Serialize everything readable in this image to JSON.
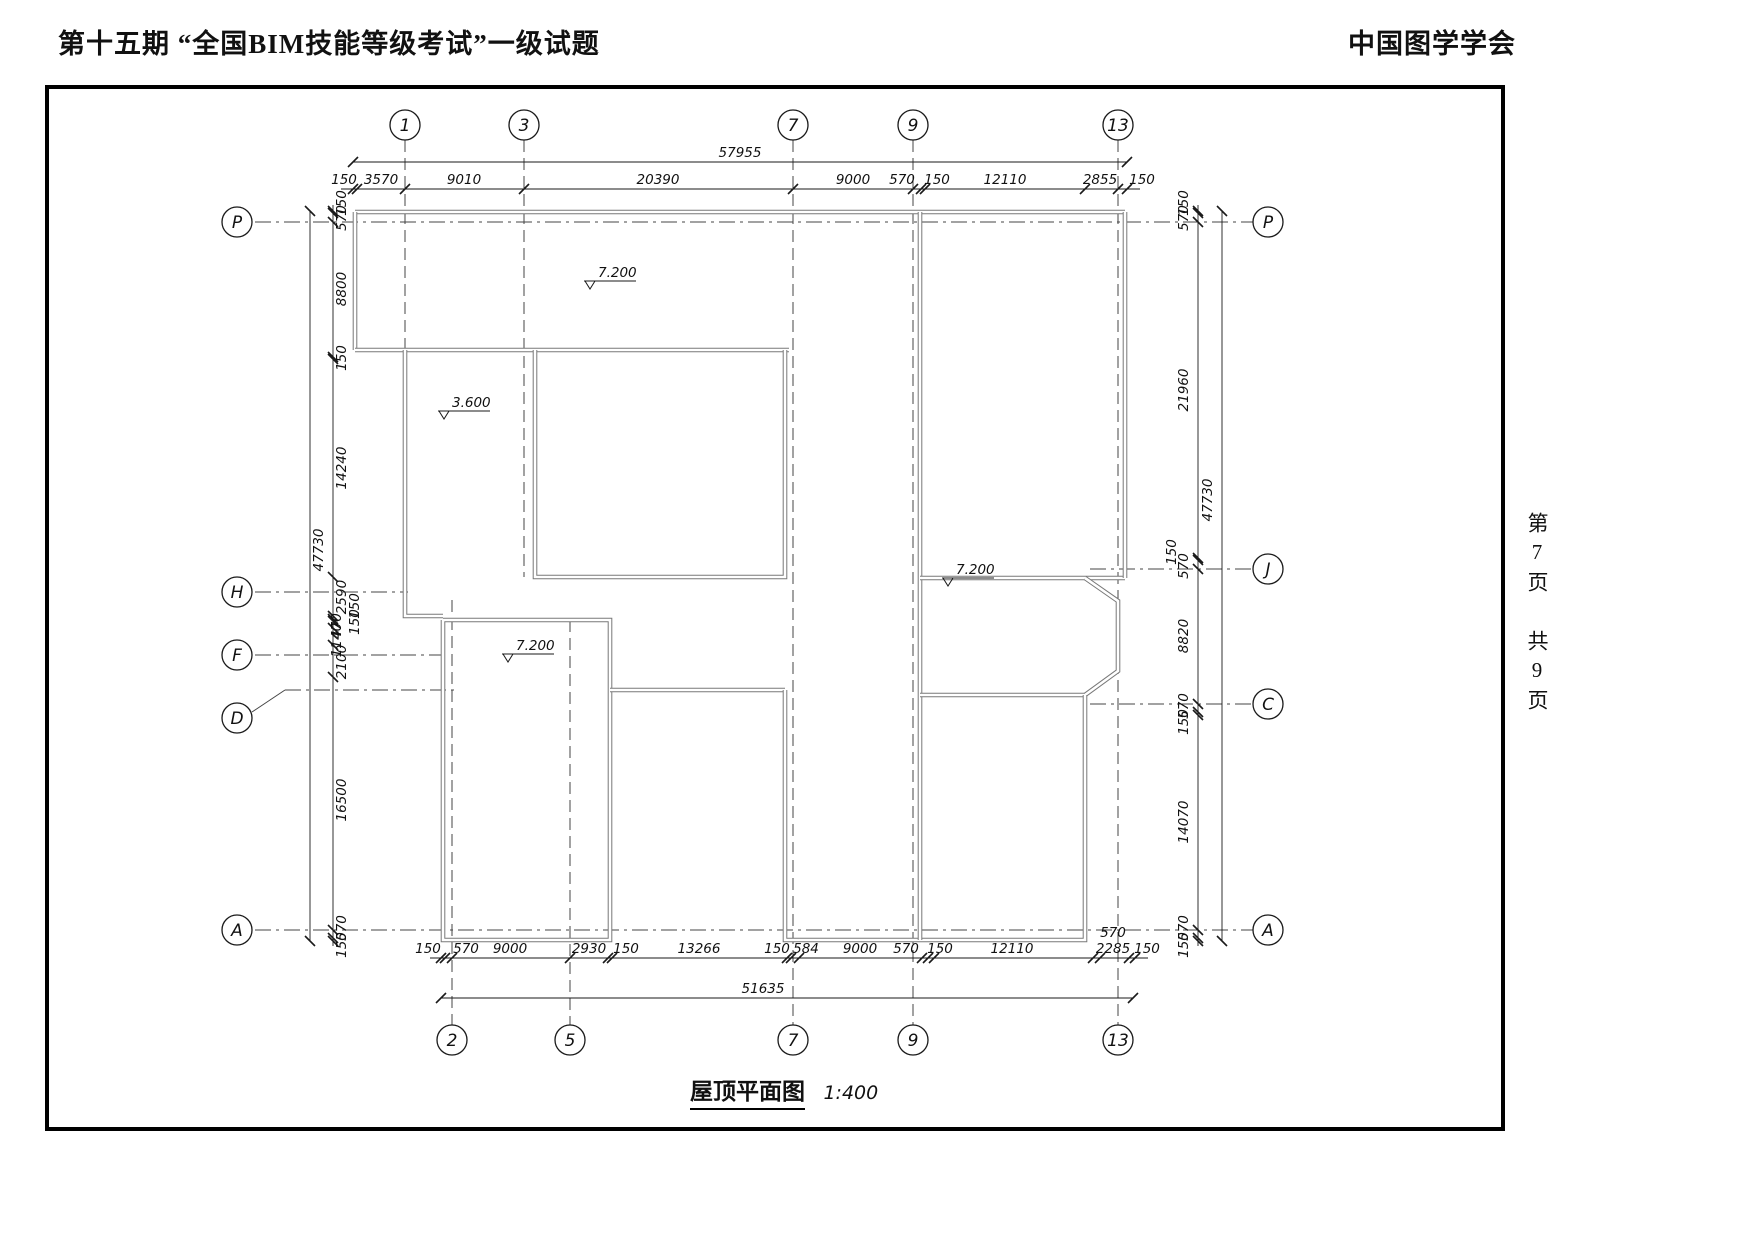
{
  "header": {
    "title_left": "第十五期 “全国BIM技能等级考试”一级试题",
    "title_right": "中国图学学会"
  },
  "side_note": {
    "text": "第7页 共9页"
  },
  "caption": {
    "title": "屋顶平面图",
    "scale": "1:400"
  },
  "drawing": {
    "colors": {
      "wall_outer": "#787878",
      "wall_inner": "#ffffff",
      "line": "#1a1a1a",
      "grid": "#444444"
    },
    "bubbles": [
      {
        "label": "1",
        "x": 405,
        "y": 125
      },
      {
        "label": "3",
        "x": 524,
        "y": 125
      },
      {
        "label": "7",
        "x": 793,
        "y": 125
      },
      {
        "label": "9",
        "x": 913,
        "y": 125
      },
      {
        "label": "13",
        "x": 1118,
        "y": 125
      },
      {
        "label": "2",
        "x": 452,
        "y": 1040
      },
      {
        "label": "5",
        "x": 570,
        "y": 1040
      },
      {
        "label": "7",
        "x": 793,
        "y": 1040
      },
      {
        "label": "9",
        "x": 913,
        "y": 1040
      },
      {
        "label": "13",
        "x": 1118,
        "y": 1040
      },
      {
        "label": "P",
        "x": 237,
        "y": 222
      },
      {
        "label": "H",
        "x": 237,
        "y": 592
      },
      {
        "label": "F",
        "x": 237,
        "y": 655
      },
      {
        "label": "D",
        "x": 237,
        "y": 718
      },
      {
        "label": "A",
        "x": 237,
        "y": 930
      },
      {
        "label": "P",
        "x": 1268,
        "y": 222
      },
      {
        "label": "J",
        "x": 1268,
        "y": 569
      },
      {
        "label": "C",
        "x": 1268,
        "y": 704
      },
      {
        "label": "A",
        "x": 1268,
        "y": 930
      }
    ],
    "vgrids": [
      {
        "x": 405,
        "y1": 140,
        "y2": 616
      },
      {
        "x": 524,
        "y1": 140,
        "y2": 577
      },
      {
        "x": 793,
        "y1": 140,
        "y2": 1025
      },
      {
        "x": 913,
        "y1": 140,
        "y2": 1025
      },
      {
        "x": 1118,
        "y1": 140,
        "y2": 1025
      },
      {
        "x": 452,
        "y1": 600,
        "y2": 1025
      },
      {
        "x": 570,
        "y1": 620,
        "y2": 1025
      }
    ],
    "hgrids": [
      {
        "y": 222,
        "x1": 255,
        "x2": 1253
      },
      {
        "y": 930,
        "x1": 255,
        "x2": 1253
      },
      {
        "y": 592,
        "x1": 255,
        "x2": 408
      },
      {
        "y": 655,
        "x1": 255,
        "x2": 445
      },
      {
        "y": 569,
        "x1": 1090,
        "x2": 1253
      },
      {
        "y": 704,
        "x1": 1090,
        "x2": 1253
      },
      {
        "y": 690,
        "x1": 285,
        "x2": 455
      }
    ],
    "leaders": [
      [
        [
          252,
          712
        ],
        [
          285,
          690
        ]
      ]
    ],
    "walls": [
      [
        [
          355,
          212
        ],
        [
          1125,
          212
        ]
      ],
      [
        [
          355,
          212
        ],
        [
          355,
          350
        ]
      ],
      [
        [
          355,
          350
        ],
        [
          789,
          350
        ]
      ],
      [
        [
          535,
          350
        ],
        [
          535,
          577
        ],
        [
          785,
          577
        ],
        [
          785,
          350
        ]
      ],
      [
        [
          405,
          350
        ],
        [
          405,
          616
        ],
        [
          443,
          616
        ]
      ],
      [
        [
          443,
          620
        ],
        [
          610,
          620
        ],
        [
          610,
          940
        ],
        [
          443,
          940
        ],
        [
          443,
          620
        ]
      ],
      [
        [
          610,
          690
        ],
        [
          785,
          690
        ]
      ],
      [
        [
          785,
          690
        ],
        [
          785,
          940
        ],
        [
          923,
          940
        ]
      ],
      [
        [
          920,
          212
        ],
        [
          920,
          940
        ]
      ],
      [
        [
          920,
          578
        ],
        [
          1125,
          578
        ]
      ],
      [
        [
          1085,
          578
        ],
        [
          1118,
          601
        ],
        [
          1118,
          671
        ],
        [
          1085,
          695
        ]
      ],
      [
        [
          920,
          695
        ],
        [
          1085,
          695
        ]
      ],
      [
        [
          1085,
          695
        ],
        [
          1085,
          940
        ],
        [
          923,
          940
        ]
      ],
      [
        [
          1125,
          212
        ],
        [
          1125,
          578
        ]
      ]
    ],
    "elevations": [
      {
        "t": "7.200",
        "x": 598,
        "y": 277
      },
      {
        "t": "3.600",
        "x": 452,
        "y": 407
      },
      {
        "t": "7.200",
        "x": 516,
        "y": 650
      },
      {
        "t": "7.200",
        "x": 956,
        "y": 574
      }
    ],
    "dims_h": [
      {
        "name": "top-total",
        "y": 162,
        "x1": 353,
        "x2": 1127,
        "ticks": [
          353,
          1127
        ],
        "labels": [
          {
            "t": "57955",
            "x": 740
          }
        ]
      },
      {
        "name": "top-segments",
        "y": 189,
        "x1": 341,
        "x2": 1140,
        "ticks": [
          353,
          357,
          405,
          524,
          793,
          913,
          921,
          925,
          1085,
          1118,
          1127
        ],
        "labels": [
          {
            "t": "150",
            "x": 344
          },
          {
            "t": "3570",
            "x": 381
          },
          {
            "t": "9010",
            "x": 464
          },
          {
            "t": "20390",
            "x": 658
          },
          {
            "t": "9000",
            "x": 853
          },
          {
            "t": "570",
            "x": 902
          },
          {
            "t": "150",
            "x": 937
          },
          {
            "t": "12110",
            "x": 1005
          },
          {
            "t": "2855",
            "x": 1100
          },
          {
            "t": "150",
            "x": 1142
          }
        ]
      },
      {
        "name": "bottom-segments",
        "y": 958,
        "x1": 430,
        "x2": 1148,
        "ticks": [
          441,
          445,
          452,
          570,
          608,
          612,
          787,
          791,
          799,
          922,
          928,
          934,
          1093,
          1100,
          1129,
          1135
        ],
        "labels": [
          {
            "t": "150",
            "x": 428
          },
          {
            "t": "570",
            "x": 466
          },
          {
            "t": "9000",
            "x": 510
          },
          {
            "t": "2930",
            "x": 589
          },
          {
            "t": "150",
            "x": 626
          },
          {
            "t": "13266",
            "x": 699
          },
          {
            "t": "150",
            "x": 777
          },
          {
            "t": "584",
            "x": 806
          },
          {
            "t": "9000",
            "x": 860
          },
          {
            "t": "570",
            "x": 906
          },
          {
            "t": "150",
            "x": 940
          },
          {
            "t": "12110",
            "x": 1012
          },
          {
            "t": "2285",
            "x": 1113
          },
          {
            "t": "150",
            "x": 1147
          },
          {
            "t": "570",
            "x": 1113,
            "dy": -16
          }
        ]
      },
      {
        "name": "bottom-total",
        "y": 998,
        "x1": 441,
        "x2": 1133,
        "ticks": [
          441,
          1133
        ],
        "labels": [
          {
            "t": "51635",
            "x": 763
          }
        ]
      }
    ],
    "dims_v": [
      {
        "name": "left-inner",
        "x": 333,
        "y1": 205,
        "y2": 946,
        "ticks": [
          211,
          213,
          222,
          357,
          359,
          577,
          616,
          619,
          621,
          628,
          645,
          677,
          930,
          938,
          941
        ],
        "labels": [
          {
            "t": "150",
            "y": 203,
            "dx": 13
          },
          {
            "t": "570",
            "y": 218,
            "dx": 13
          },
          {
            "t": "8800",
            "y": 289,
            "dx": 13
          },
          {
            "t": "150",
            "y": 358,
            "dx": 13
          },
          {
            "t": "14240",
            "y": 468,
            "dx": 13
          },
          {
            "t": "2590",
            "y": 597,
            "dx": 13
          },
          {
            "t": "150",
            "y": 606,
            "dx": 26
          },
          {
            "t": "150",
            "y": 622,
            "dx": 26
          },
          {
            "t": "470",
            "y": 626,
            "dx": 8
          },
          {
            "t": "1140",
            "y": 640,
            "dx": 8
          },
          {
            "t": "2100",
            "y": 662,
            "dx": 13
          },
          {
            "t": "16500",
            "y": 800,
            "dx": 13
          },
          {
            "t": "570",
            "y": 928,
            "dx": 13
          },
          {
            "t": "150",
            "y": 945,
            "dx": 13
          }
        ]
      },
      {
        "name": "left-outer",
        "x": 310,
        "y1": 211,
        "y2": 941,
        "ticks": [
          211,
          941
        ],
        "labels": [
          {
            "t": "47730",
            "y": 550,
            "dx": 13
          }
        ]
      },
      {
        "name": "right-inner",
        "x": 1198,
        "y1": 205,
        "y2": 946,
        "ticks": [
          211,
          213,
          222,
          558,
          560,
          569,
          704,
          712,
          715,
          930,
          938,
          941
        ],
        "labels": [
          {
            "t": "150",
            "y": 203,
            "dx": -10
          },
          {
            "t": "570",
            "y": 218,
            "dx": -10
          },
          {
            "t": "21960",
            "y": 390,
            "dx": -10
          },
          {
            "t": "150",
            "y": 552,
            "dx": -22
          },
          {
            "t": "570",
            "y": 566,
            "dx": -10
          },
          {
            "t": "8820",
            "y": 636,
            "dx": -10
          },
          {
            "t": "570",
            "y": 706,
            "dx": -10
          },
          {
            "t": "150",
            "y": 722,
            "dx": -10
          },
          {
            "t": "14070",
            "y": 822,
            "dx": -10
          },
          {
            "t": "570",
            "y": 928,
            "dx": -10
          },
          {
            "t": "150",
            "y": 945,
            "dx": -10
          }
        ]
      },
      {
        "name": "right-outer",
        "x": 1222,
        "y1": 211,
        "y2": 941,
        "ticks": [
          211,
          941
        ],
        "labels": [
          {
            "t": "47730",
            "y": 500,
            "dx": -10
          }
        ]
      }
    ]
  }
}
